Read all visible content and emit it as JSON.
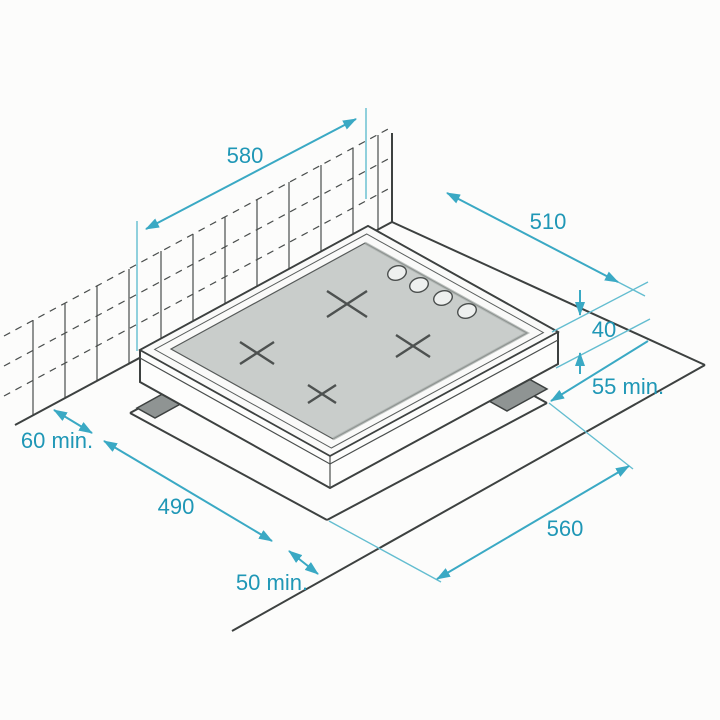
{
  "diagram": {
    "kind": "hob-installation-dimensions",
    "colors": {
      "dimension_line": "#3aa9c4",
      "dimension_text": "#1f97b6",
      "outline": "#3d4140",
      "glass": "#c9cdcb",
      "bracket": "#8f9493",
      "background": "#fcfcfb"
    },
    "hob": {
      "burner_count": 4,
      "knob_count": 4
    },
    "dimensions": [
      {
        "id": "hob-width",
        "label": "580"
      },
      {
        "id": "hob-depth",
        "label": "510"
      },
      {
        "id": "hob-thickness",
        "label": "40"
      },
      {
        "id": "clearance-rear",
        "label": "55 min."
      },
      {
        "id": "clearance-left",
        "label": "60 min."
      },
      {
        "id": "cutout-depth",
        "label": "490"
      },
      {
        "id": "clearance-front",
        "label": "50 min."
      },
      {
        "id": "cutout-width",
        "label": "560"
      }
    ]
  }
}
